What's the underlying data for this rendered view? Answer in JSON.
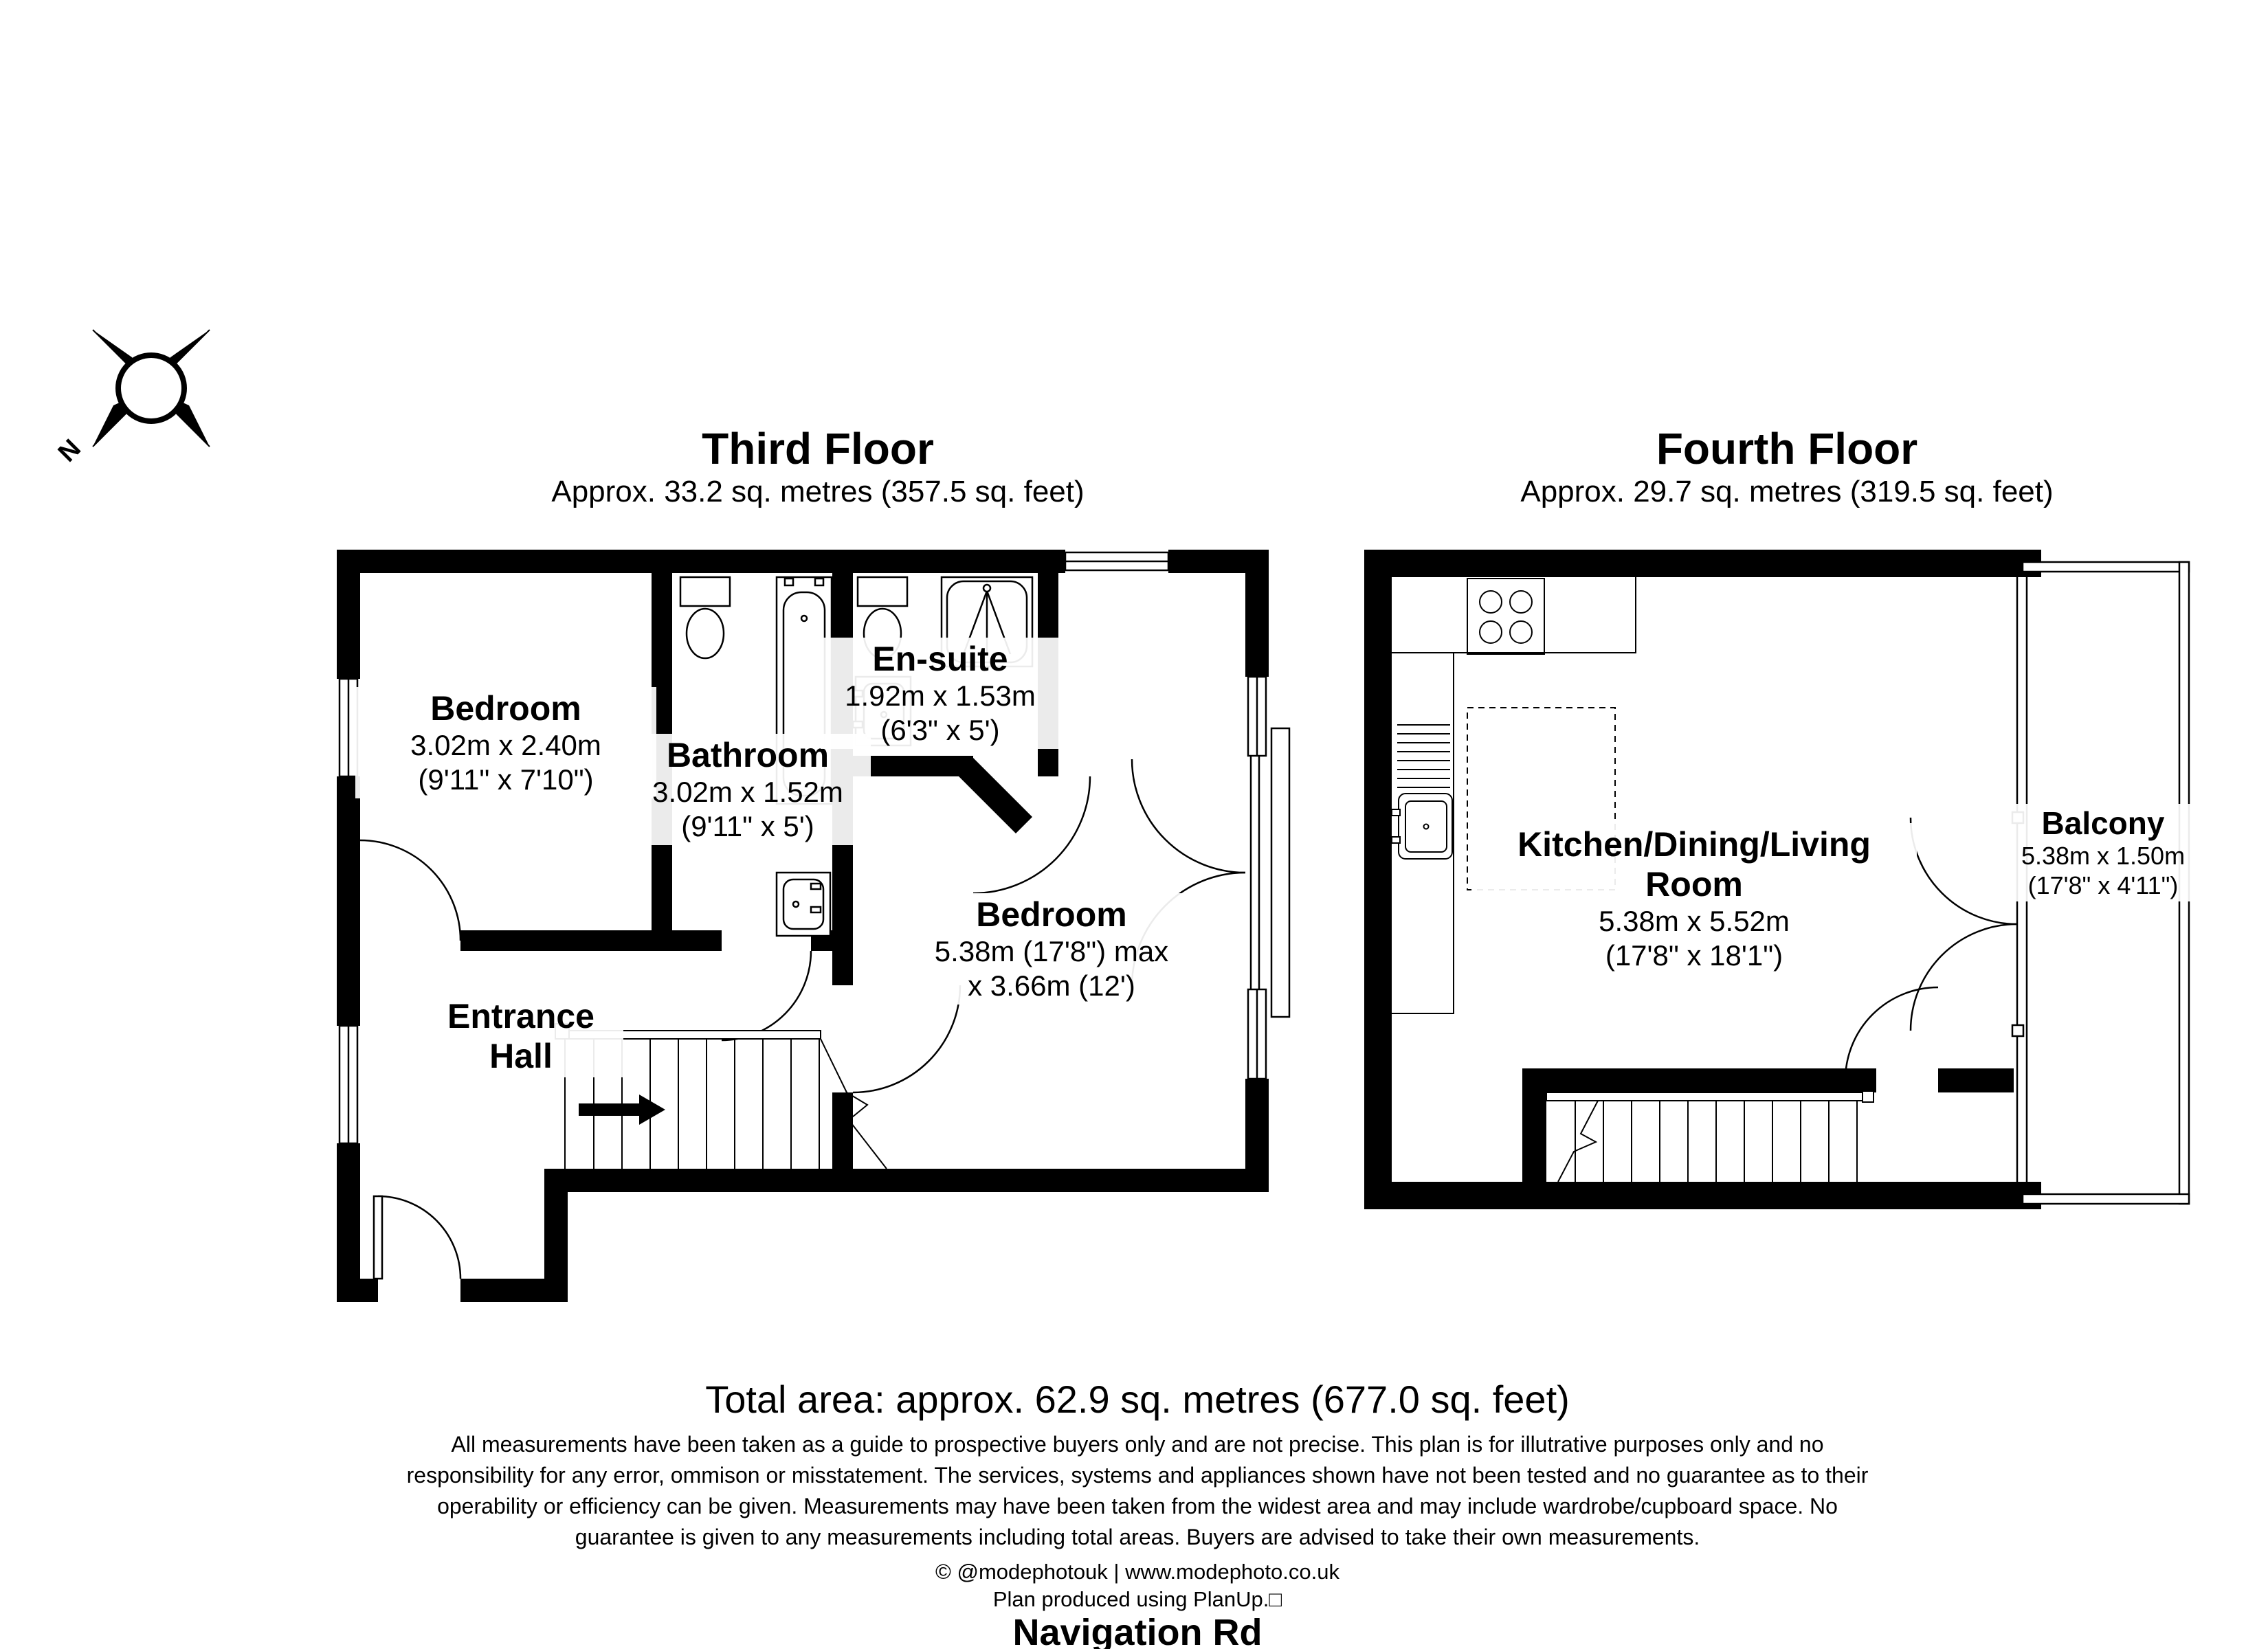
{
  "colors": {
    "walls": "#000000",
    "background": "#ffffff",
    "text": "#000000"
  },
  "compass": {
    "north_label": "N"
  },
  "floors": [
    {
      "title": "Third Floor",
      "subtitle": "Approx. 33.2 sq. metres (357.5 sq. feet)",
      "rooms": [
        {
          "name": "Bedroom",
          "dim1": "3.02m x 2.40m",
          "dim2": "(9'11\" x 7'10\")"
        },
        {
          "name": "Bathroom",
          "dim1": "3.02m x 1.52m",
          "dim2": "(9'11\" x 5')"
        },
        {
          "name": "En-suite",
          "dim1": "1.92m x 1.53m",
          "dim2": "(6'3\" x 5')"
        },
        {
          "name": "Bedroom",
          "dim1": "5.38m (17'8\") max",
          "dim2": "x 3.66m (12')"
        },
        {
          "name": "Entrance Hall"
        }
      ]
    },
    {
      "title": "Fourth Floor",
      "subtitle": "Approx. 29.7 sq. metres (319.5 sq. feet)",
      "rooms": [
        {
          "name": "Kitchen/Dining/Living Room",
          "dim1": "5.38m x 5.52m",
          "dim2": "(17'8\" x 18'1\")"
        },
        {
          "name": "Balcony",
          "dim1": "5.38m x 1.50m",
          "dim2": "(17'8\" x 4'11\")"
        }
      ]
    }
  ],
  "summary": {
    "total_area": "Total area: approx. 62.9 sq. metres (677.0 sq. feet)"
  },
  "disclaimer": {
    "lines": [
      "All measurements have been taken as a guide to prospective buyers only and are not precise. This plan is for illutrative purposes only and no",
      "responsibility for any error, ommison or misstatement. The services, systems and appliances shown have not been tested and no guarantee as to their",
      "operability or efficiency can be given. Measurements may have been taken from the widest area and may include wardrobe/cupboard space. No",
      "guarantee is given to any measurements including total areas. Buyers are advised to take their own measurements."
    ]
  },
  "credits": {
    "copyright": "© @modephotouk | www.modephoto.co.uk",
    "produced": "Plan produced using PlanUp.□",
    "address": "Navigation Rd"
  }
}
